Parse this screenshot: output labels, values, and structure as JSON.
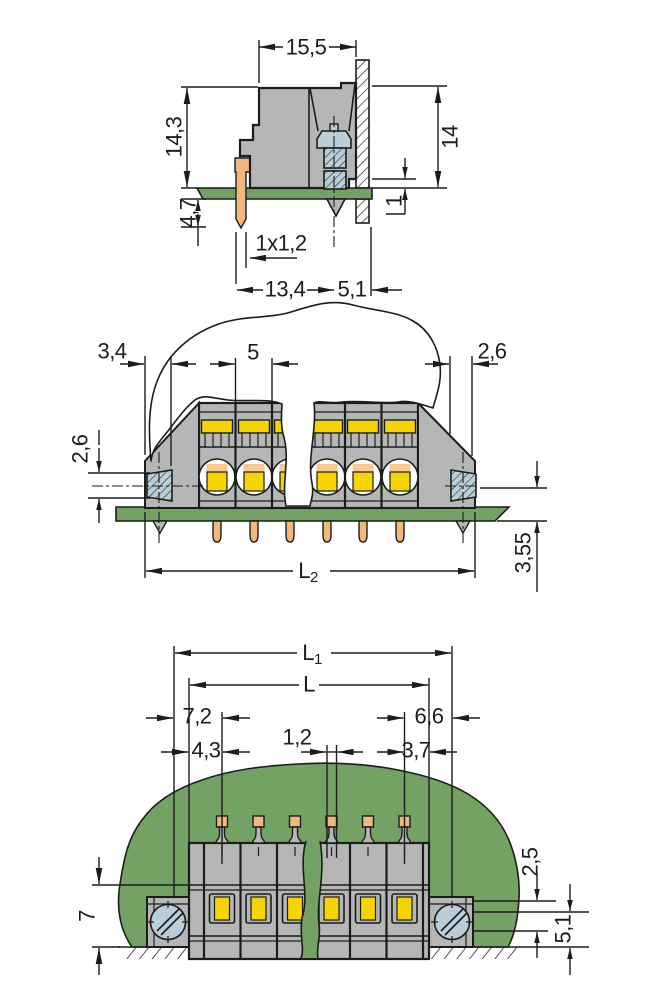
{
  "colors": {
    "ink": "#1c1c1c",
    "paper": "#ffffff",
    "body_gray": "#b5b7b6",
    "yellow": "#f5d402",
    "peach": "#f6c993",
    "orange": "#f1b77e",
    "green": "#74a164",
    "screw_blue": "#b9ced9"
  },
  "views": {
    "side": {
      "dims": {
        "width_top": "15,5",
        "height_left": "14,3",
        "height_right": "14",
        "below_board": "4,7",
        "panel_step": "1",
        "pin_section": "1x1,2",
        "length_a": "13,4",
        "length_b": "5,1"
      }
    },
    "front": {
      "dims": {
        "end_left": "3,4",
        "pitch": "5",
        "end_right": "2,6",
        "screw_height": "2,6",
        "pin_drop": "3,55",
        "total_main": "L",
        "total_sub": "2"
      }
    },
    "mounted": {
      "dims": {
        "overall_main": "L",
        "overall_sub": "1",
        "body_main": "L",
        "left_outer": "7,2",
        "left_inner": "4,3",
        "pin_width": "1,2",
        "right_outer": "6,6",
        "right_inner": "3,7",
        "height": "7",
        "offset_top": "2,5",
        "offset_bottom": "5,1"
      }
    }
  }
}
